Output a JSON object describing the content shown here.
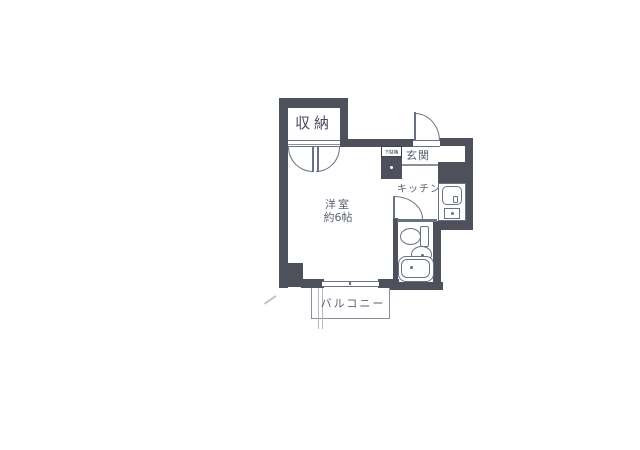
{
  "colors": {
    "wall": "#4e515c",
    "line": "#6b7184",
    "thin_line": "#8a8f9c",
    "text": "#5a6070",
    "bg": "#ffffff"
  },
  "labels": {
    "storage": "収納",
    "entrance": "玄関",
    "shoe_cabinet": "下駄箱",
    "kitchen": "キッチン",
    "room_name": "洋室",
    "room_size": "約6帖",
    "balcony": "バルコニー"
  },
  "fixtures": [
    "kitchen-sink",
    "stove-burner",
    "toilet",
    "vanity-sink",
    "bathtub"
  ],
  "doors": [
    "entrance-swing-door",
    "closet-double-doors",
    "bathroom-swing-door",
    "balcony-sliding-window"
  ]
}
